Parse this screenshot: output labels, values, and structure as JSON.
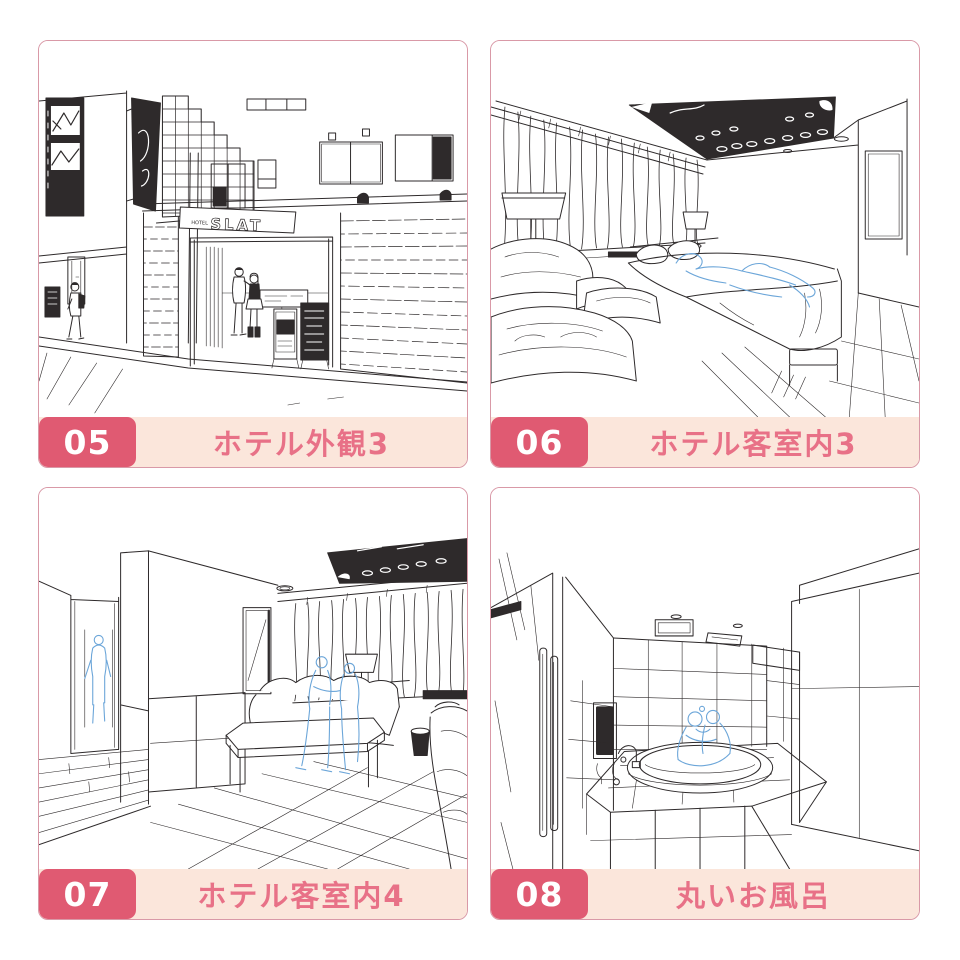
{
  "page": {
    "background": "#ffffff"
  },
  "colors": {
    "card_border": "#d999a7",
    "badge_background": "#e05a72",
    "badge_text": "#ffffff",
    "label_bar_background": "#fbe6db",
    "label_text": "#e87187",
    "line_art": "#2e2a2b",
    "sketch_blue": "#6ca6d9"
  },
  "cards": [
    {
      "number": "05",
      "label": "ホテル外観3",
      "illustration": "hotel-exterior"
    },
    {
      "number": "06",
      "label": "ホテル客室内3",
      "illustration": "hotel-guest-room-3"
    },
    {
      "number": "07",
      "label": "ホテル客室内4",
      "illustration": "hotel-guest-room-4"
    },
    {
      "number": "08",
      "label": "丸いお風呂",
      "illustration": "round-bath"
    }
  ],
  "illustrations": {
    "hotel_exterior": {
      "sign_prefix": "HOTEL",
      "sign_text": "SLAT"
    }
  }
}
